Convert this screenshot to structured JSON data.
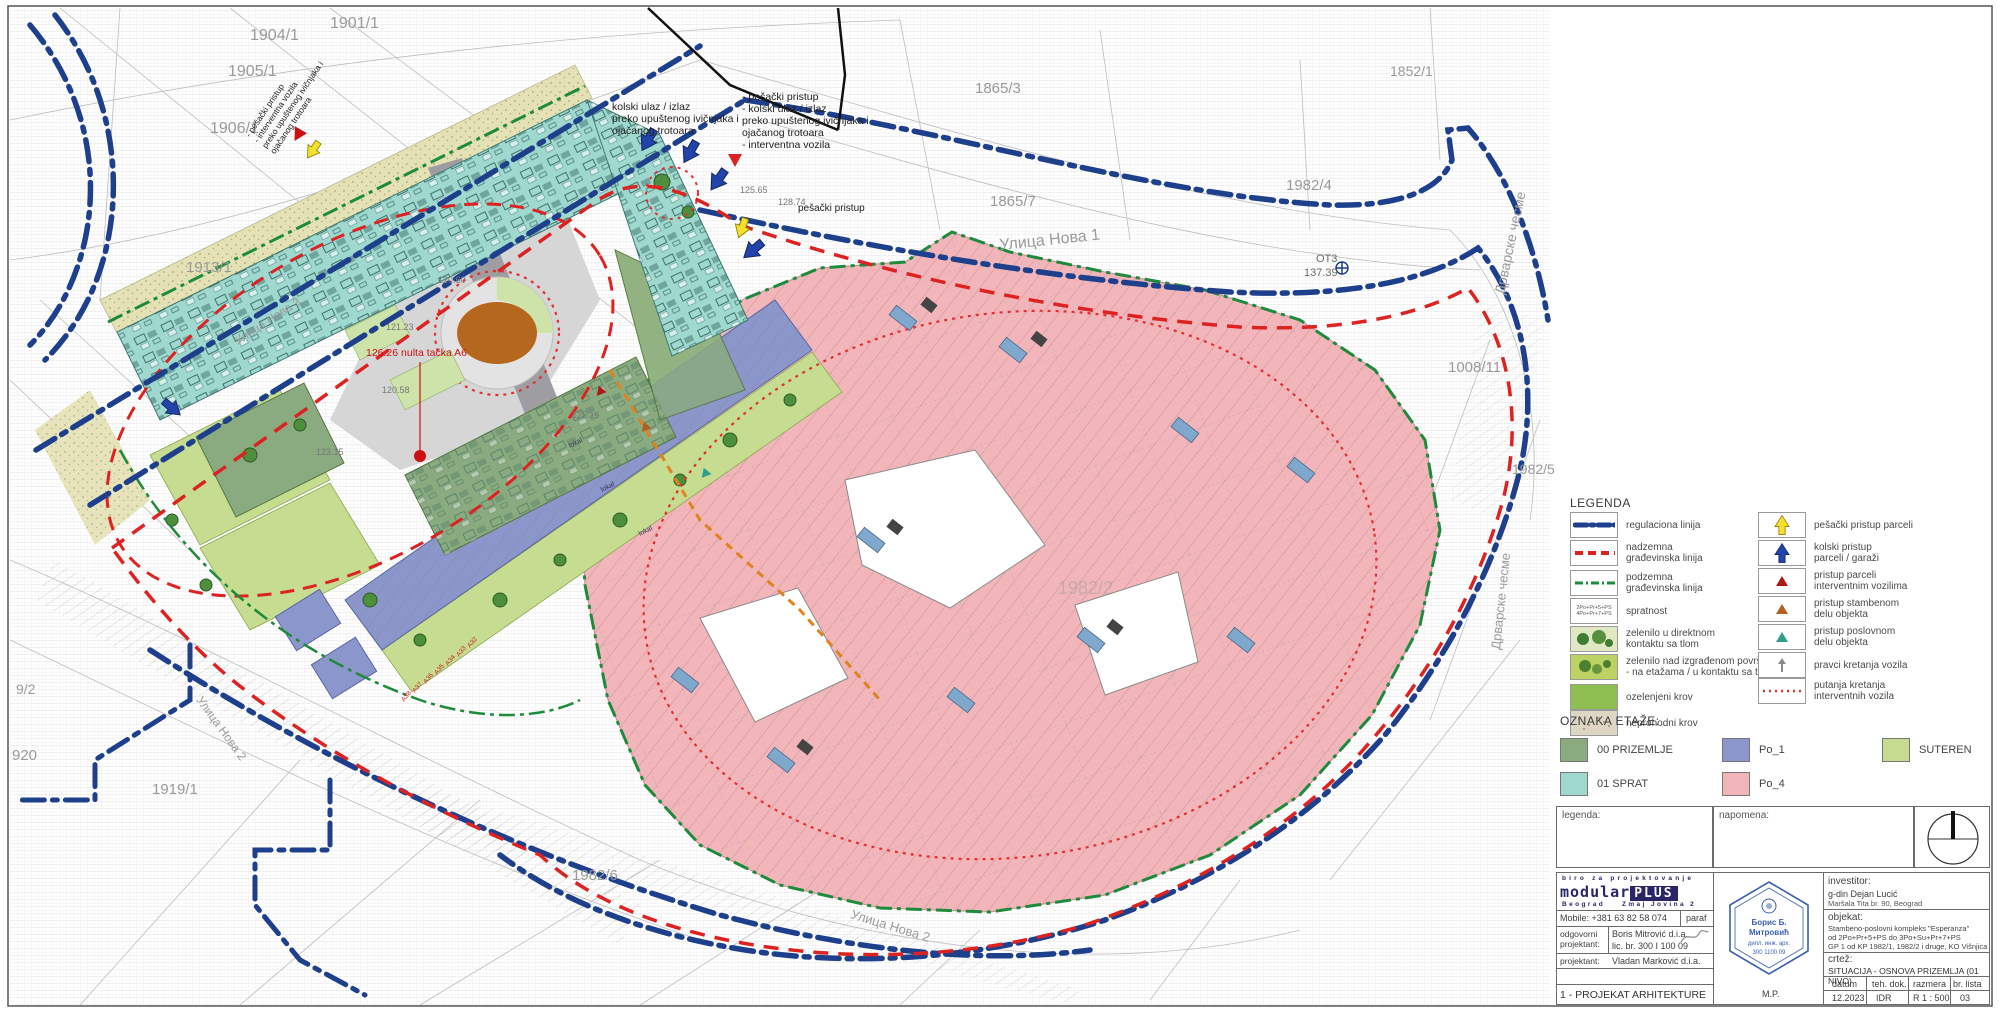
{
  "colors": {
    "regulation_blue": "#1d3f8c",
    "building_line_red": "#dd2222",
    "underground_green": "#1e8a3c",
    "floor_00_prizemlje": "#8aab80",
    "floor_01_sprat": "#9fd8cf",
    "floor_po1": "#8b96cb",
    "floor_po4": "#f2b6ba",
    "floor_suteren": "#c6dc91",
    "playground_orange": "#b5671d"
  },
  "legend": {
    "title": "LEGENDA",
    "left": [
      {
        "label1": "regulaciona linija",
        "label2": ""
      },
      {
        "label1": "nadzemna",
        "label2": "građevinska linija"
      },
      {
        "label1": "podzemna",
        "label2": "građevinska linija"
      },
      {
        "label1": "spratnost",
        "label2": "",
        "box1": "2Po+Pr+5+PS",
        "box2": "4Po+Pr+7+PS"
      },
      {
        "label1": "zelenilo u direktnom",
        "label2": "kontaktu sa tlom"
      },
      {
        "label1": "zelenilo nad izgrađenom površinom",
        "label2": "- na etažama / u kontaktu sa tlom"
      },
      {
        "label1": "ozelenjeni krov",
        "label2": ""
      },
      {
        "label1": "neprohodni krov",
        "label2": ""
      }
    ],
    "right": [
      {
        "label1": "pešački pristup parceli",
        "label2": ""
      },
      {
        "label1": "kolski pristup",
        "label2": "parceli / garaži"
      },
      {
        "label1": "pristup parceli",
        "label2": "interventnim vozilima"
      },
      {
        "label1": "pristup stambenom",
        "label2": "delu objekta"
      },
      {
        "label1": "pristup poslovnom",
        "label2": "delu objekta"
      },
      {
        "label1": "pravci kretanja vozila",
        "label2": ""
      },
      {
        "label1": "putanja kretanja",
        "label2": "interventnih vozila"
      }
    ]
  },
  "oznaka": {
    "title": "OZNAKA ETAŽE:",
    "items": [
      {
        "label": "00 PRIZEMLJE",
        "color": "#8aab80"
      },
      {
        "label": "01 SPRAT",
        "color": "#9fd8cf"
      },
      {
        "label": "Po_1",
        "color": "#8b96cb"
      },
      {
        "label": "Po_4",
        "color": "#f2b6ba"
      },
      {
        "label": "SUTEREN",
        "color": "#c6dc91"
      }
    ]
  },
  "strip": {
    "legenda": "legenda:",
    "napomena": "napomena:"
  },
  "titleblock": {
    "firm_top": "biro za projektovanje",
    "firm_name_a": "modular",
    "firm_name_b": "PLUS",
    "firm_city": "Beograd",
    "firm_addr": "Zmaj Jovina 2",
    "mobile": "Mobile: +381 63 82 58 074",
    "paraf": "paraf",
    "role1a": "odgovorni",
    "role1b": "projektant:",
    "resp_name": "Boris Mitrović d.i.a.",
    "resp_lic": "lic. br. 300 I 100 09",
    "role2": "projektant:",
    "designer": "Vladan Marković d.i.a.",
    "project_no": "1 - PROJEKAT ARHITEKTURE",
    "stamp_mp": "M.P.",
    "stamp_l1": "Борис Б.",
    "stamp_l2": "Митровић",
    "stamp_l3": "дипл. инж. арх.",
    "stamp_l4": "300 1100 09",
    "investor_label": "investitor:",
    "investor_name": "g-din Dejan Lucić",
    "investor_addr": "Maršala Tita br. 90, Beograd",
    "object_label": "objekat:",
    "object_l1": "Stambeno-poslovni kompleks \"Esperanza\"",
    "object_l2": "od 2Po+Pr+5+PS do 3Po+Su+Pr+7+PS",
    "object_l3": "GP 1 od KP 1982/1, 1982/2 i druge, KO Višnjica",
    "drawing_label": "crtež:",
    "drawing_title": "SITUACIJA - OSNOVA PRIZEMLJA (01 NIVO)",
    "col_datum": "datum",
    "col_teh": "teh. dok.",
    "col_razmera": "razmera",
    "col_br": "br. lista",
    "val_datum": "12.2023",
    "val_teh": "IDR",
    "val_razmera": "R 1 : 500",
    "val_br": "03"
  },
  "map": {
    "streets": {
      "nova1": "Улица Нова 1",
      "nova2a": "Улица Нова 2",
      "nova2b": "Улица Нова 2",
      "nova3": "Улица Нова 3",
      "drvarske_a": "Дрварске чесме",
      "drvarske_b": "Дрварске чесме"
    },
    "parcels": {
      "p1901": "1901/1",
      "p1904": "1904/1",
      "p1905": "1905/1",
      "p1906": "1906/1",
      "p1913": "1913/1",
      "p1852": "1852/1",
      "p1865_3": "1865/3",
      "p1865_7": "1865/7",
      "p1982_4": "1982/4",
      "p1982_5": "1982/5",
      "p1982_6": "1982/6",
      "p1982_2": "1982/2",
      "p1008": "1008/11",
      "p1919": "1919/1",
      "p920": "920",
      "p9_2": "9/2"
    },
    "benchmark": {
      "name": "ОТ3",
      "value": "137.39"
    },
    "noteA": [
      "kolski ulaz / izlaz",
      "preko upuštenog ivičnjaka i",
      "ojačanog trotoara"
    ],
    "noteB": [
      "- pešački pristup",
      "- kolski ulaz / izlaz",
      "preko upuštenog ivičnjaka i",
      "ojačanog trotoara",
      "- interventna vozila"
    ],
    "noteC": [
      "- pešački pristup",
      "- interventna vozila",
      "preko upuštenog ivičnjaka i",
      "ojačanog trotoara"
    ],
    "pedestrian": "pešački pristup",
    "nulta": "126.26 nulta tačka A6",
    "lokal": "lokal",
    "stalls": [
      "A32",
      "A33",
      "A34",
      "A35",
      "A36",
      "A37",
      "A38"
    ],
    "elev": {
      "e1": "121.23",
      "e2": "120.60",
      "e3": "120.58",
      "e4": "125.65",
      "e5": "128.74",
      "e6": "123.15",
      "e7": "125.16"
    }
  }
}
